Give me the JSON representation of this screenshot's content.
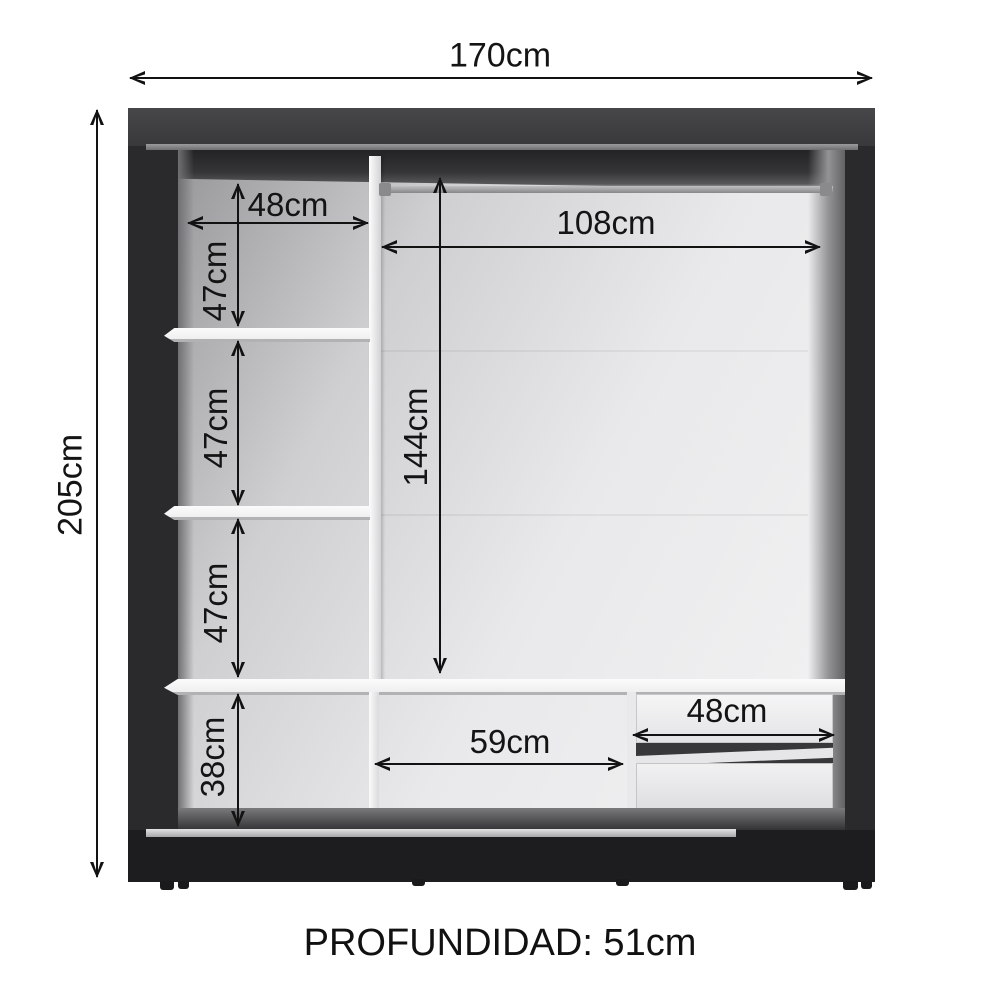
{
  "diagram": {
    "overall": {
      "width": "170cm",
      "height": "205cm"
    },
    "left_column": {
      "shelf_width": "48cm",
      "section_heights": [
        "47cm",
        "47cm",
        "47cm"
      ],
      "bottom_section_height": "38cm"
    },
    "hanging_section": {
      "rod_width": "108cm",
      "hanging_height": "144cm"
    },
    "bottom_row": {
      "middle_width": "59cm",
      "drawer_width": "48cm"
    },
    "footer": "PROFUNDIDAD: 51cm"
  },
  "colors": {
    "frame_dark": "#2a2a2d",
    "frame_top": "#3a3a3d",
    "base": "#1d1d20",
    "interior_light": "#f2f2f3",
    "interior_shadow": "#97979a",
    "shelf_white": "#fbfbfc",
    "rod_gray": "#9b9b9e",
    "track_gray": "#cfcfd1",
    "dimension_line": "#121212",
    "background": "#ffffff"
  }
}
